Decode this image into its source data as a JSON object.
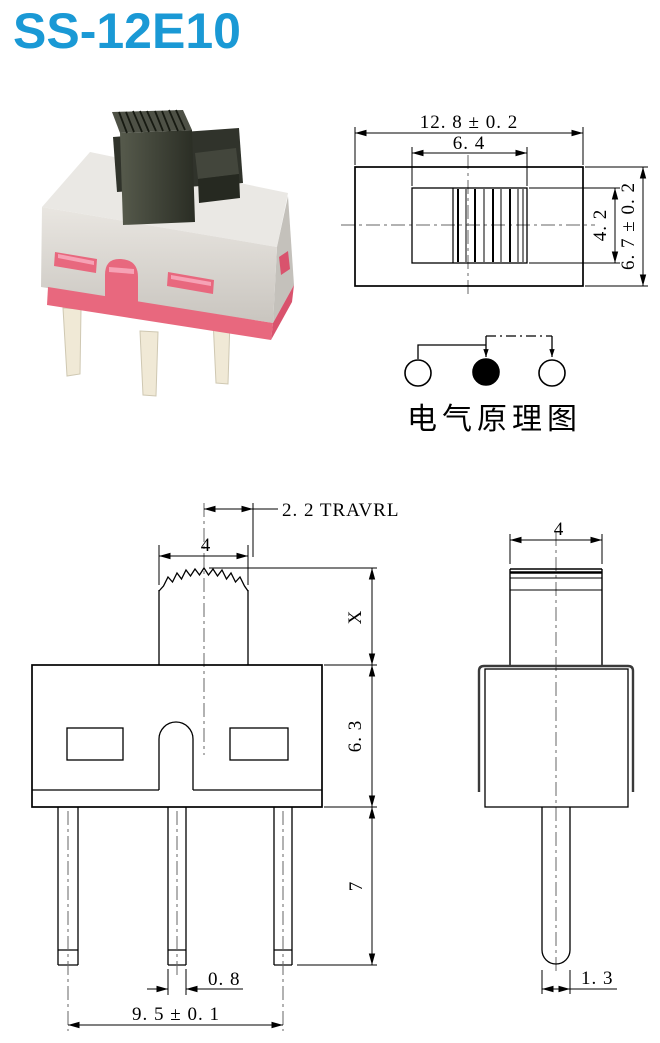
{
  "page": {
    "title": "SS-12E10",
    "accent_color": "#1a99d5",
    "background": "#ffffff"
  },
  "photo": {
    "alt": "slide-switch-product-photo",
    "body_color": "#d9d6d0",
    "base_color": "#e8687e",
    "knob_color": "#3a3d33",
    "pin_color": "#f0e9d6"
  },
  "top_view": {
    "dims": {
      "overall_width": "12. 8 ± 0. 2",
      "slot_width": "6. 4",
      "slot_height": "4. 2",
      "overall_height": "6. 7 ± 0. 2"
    }
  },
  "schematic": {
    "label": "电气原理图",
    "positions": [
      "open",
      "closed",
      "open"
    ]
  },
  "front_view": {
    "dims": {
      "travel": "2. 2 TRAVRL",
      "knob_width": "4",
      "stem_height": "X",
      "body_height": "6. 3",
      "pin_length": "7",
      "pin_width": "0. 8",
      "pin_pitch": "9. 5 ± 0. 1"
    }
  },
  "side_view": {
    "dims": {
      "knob_depth": "4",
      "pin_tip_width": "1. 3"
    }
  }
}
